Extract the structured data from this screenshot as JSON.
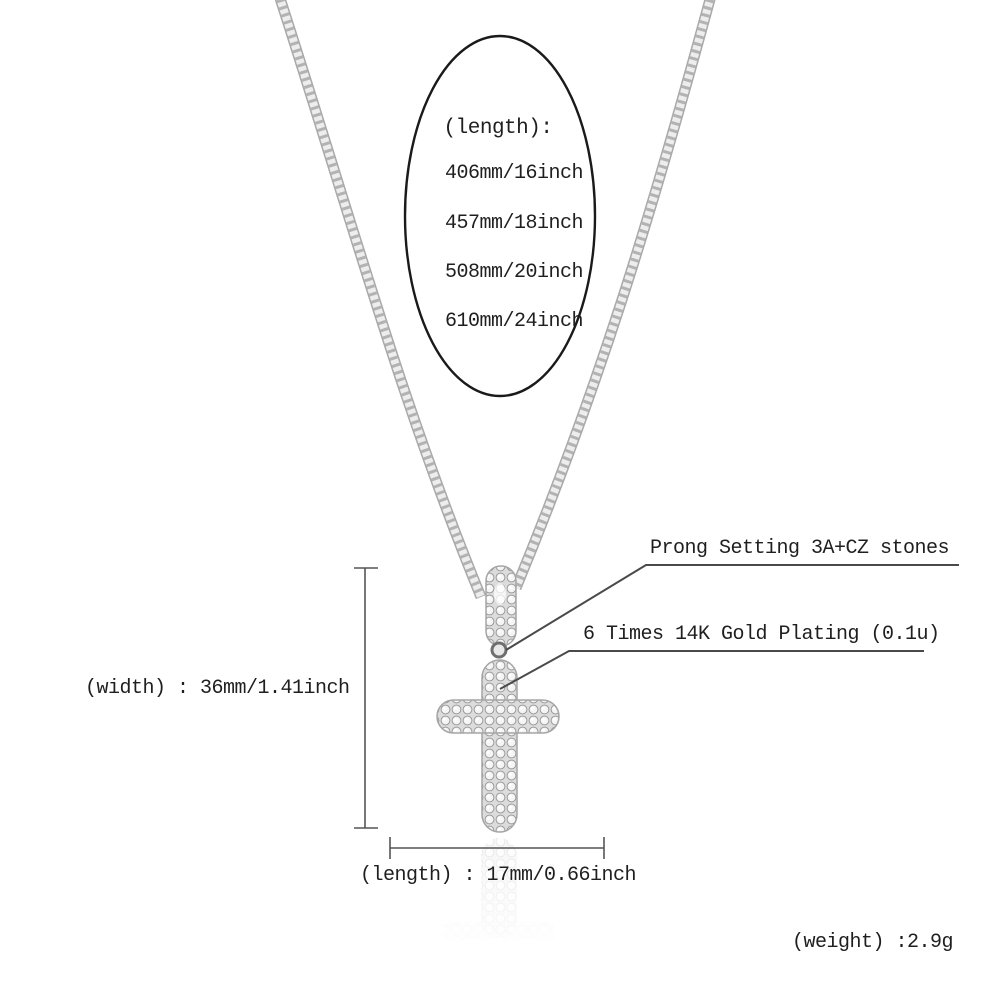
{
  "colors": {
    "background": "#ffffff",
    "text": "#1f1f1f",
    "annotation_line": "#4a4a4a",
    "ellipse_outline": "#1a1a1a",
    "chain_edge": "#a9a9a9",
    "chain_body": "#ededed",
    "chain_link": "#8c8c8c",
    "stone_bg": "#dcdcdc",
    "stone_fill": "#f5f5f5",
    "stone_edge": "#9b9b9b",
    "metal_outline": "#a5a5a5"
  },
  "size_chart": {
    "title": "(length):",
    "options": [
      "406mm/16inch",
      "457mm/18inch",
      "508mm/20inch",
      "610mm/24inch"
    ]
  },
  "callouts": {
    "prong": "Prong Setting 3A+CZ stones",
    "plating": "6 Times 14K Gold Plating (0.1u)"
  },
  "measurements": {
    "width": "(width) : 36mm/1.41inch",
    "length": "(length) : 17mm/0.66inch",
    "weight": "(weight) :2.9g"
  }
}
